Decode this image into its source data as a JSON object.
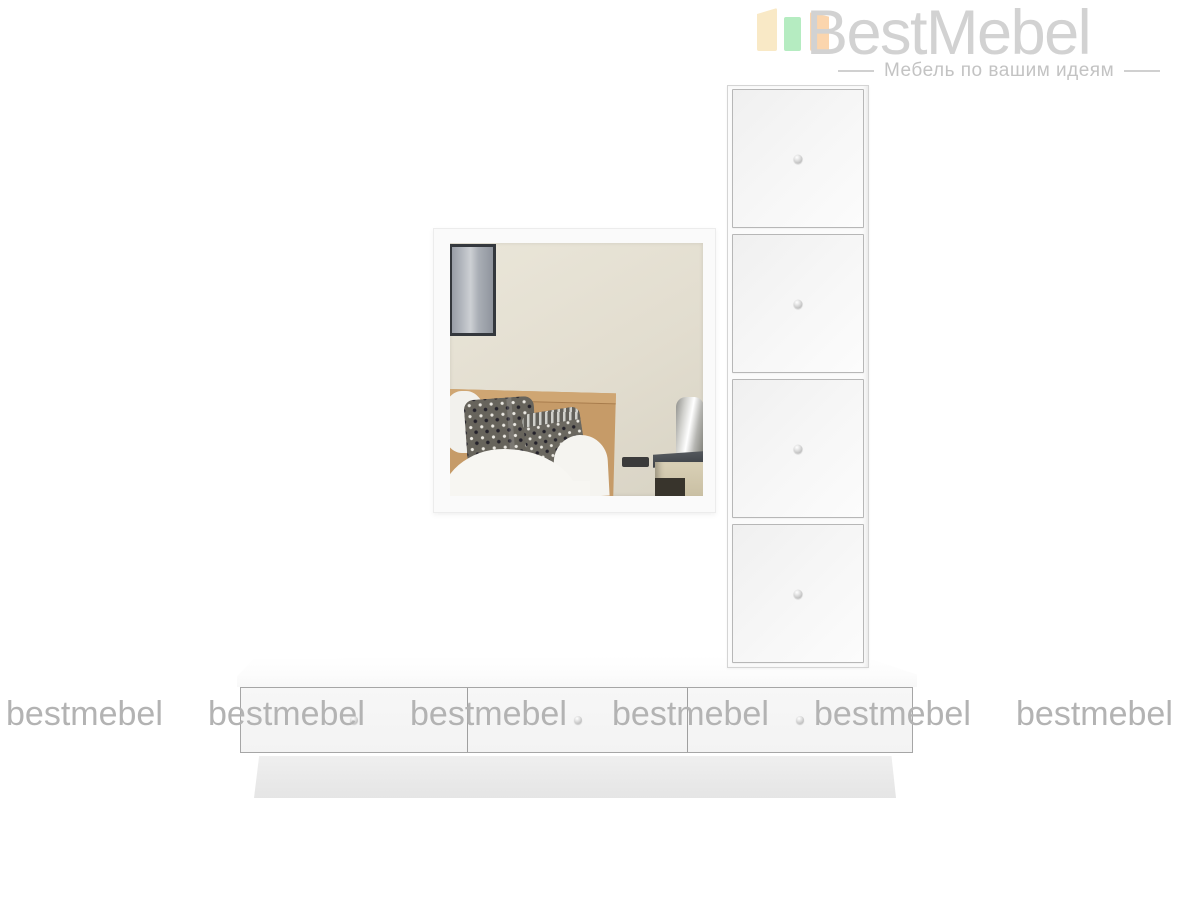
{
  "brand": {
    "name": "BestMebel",
    "tagline": "Мебель по вашим идеям",
    "name_color": "#d2d2d2",
    "tagline_color": "#c3c3c3",
    "logo_bar_colors": {
      "left": "#f9e9c6",
      "middle": "#b5ecc1",
      "right": "#fbd5ad"
    }
  },
  "watermark": {
    "text": "bestmebel",
    "color": "#b3b3b3",
    "count": 6
  },
  "product": {
    "furniture_color": "#f7f7f7",
    "edge_color": "#b7b7b7",
    "cabinet_door_count": 4,
    "dresser_drawer_count": 3,
    "mirror_present": true
  }
}
